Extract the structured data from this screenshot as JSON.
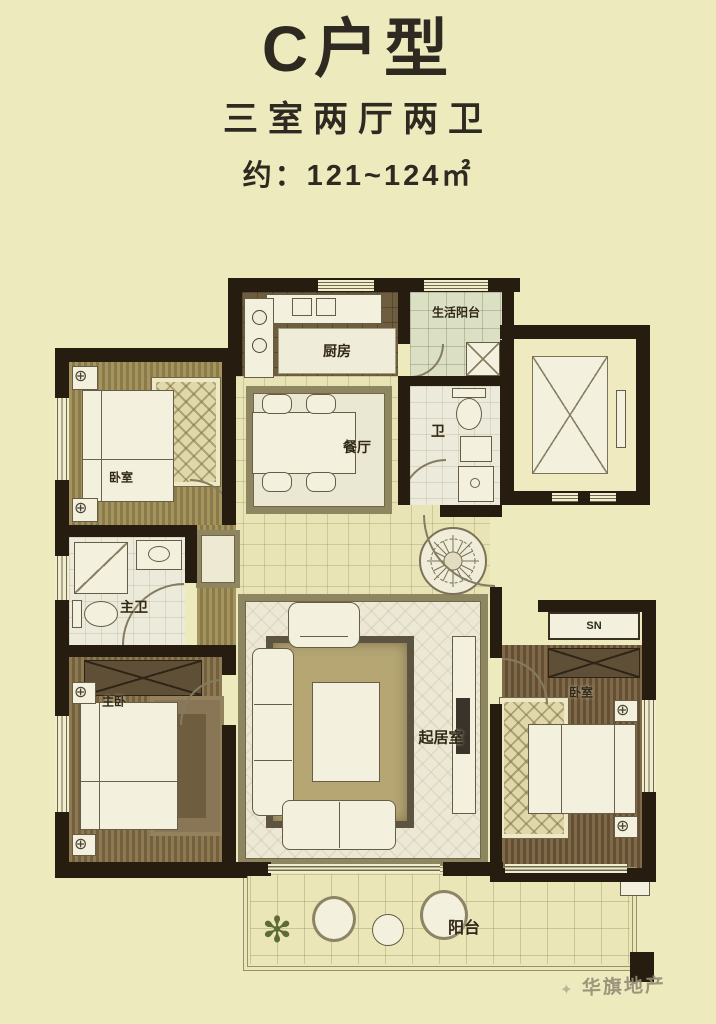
{
  "header": {
    "title": "C户型",
    "subtitle": "三室两厅两卫",
    "area": "约：121~124㎡"
  },
  "rooms": {
    "bedroom_top_left": {
      "label": "卧室"
    },
    "kitchen": {
      "label": "厨房"
    },
    "service_balcony": {
      "label": "生活阳台"
    },
    "bathroom": {
      "label": "卫"
    },
    "dining_room": {
      "label": "餐厅"
    },
    "master_bathroom": {
      "label": "主卫"
    },
    "master_bedroom": {
      "label": "主卧"
    },
    "living_room": {
      "label": "起居室"
    },
    "bedroom_right": {
      "label": "卧室"
    },
    "balcony": {
      "label": "阳台"
    }
  },
  "annotations": {
    "cabinet_label": "SN"
  },
  "watermark": {
    "brand": "华旗地产",
    "logo": "✦"
  },
  "colors": {
    "page_bg": "#edeabd",
    "wall": "#271c10",
    "title_text": "#2e2a22",
    "wood_light": "#93834f",
    "wood_dark": "#6f5b3e",
    "floor_light": "#ece8d5",
    "service_balcony_green": "#dbe0c5",
    "frame_olive": "#8e8660",
    "watermark_gray": "#948b74"
  }
}
